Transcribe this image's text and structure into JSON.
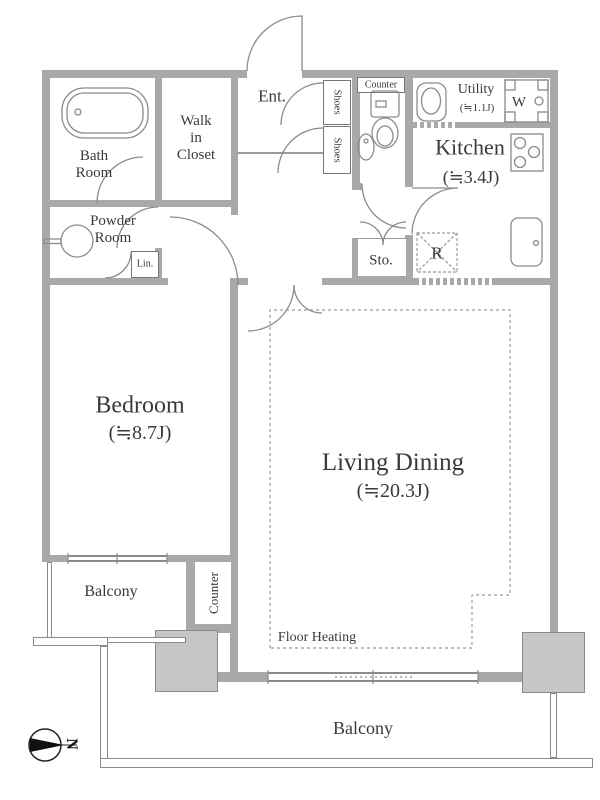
{
  "colors": {
    "wall": "#a9a9a9",
    "pillar": "#c6c6c6",
    "line": "#8b8b8b",
    "dashed_outline": "#999999",
    "text": "#3a3a3a",
    "compass": "#111111"
  },
  "labels": {
    "entrance": "Ent.",
    "bath_room": "Bath\nRoom",
    "walk_in_closet": "Walk\nin\nCloset",
    "powder_room": "Powder\nRoom",
    "linen": "Lin.",
    "shoes_upper": "Shoes",
    "shoes_lower": "Shoes",
    "wc_counter": "Counter",
    "utility": "Utility",
    "utility_size": "(≒1.1J)",
    "washer": "W",
    "kitchen": "Kitchen",
    "kitchen_size": "(≒3.4J)",
    "storage": "Sto.",
    "refrigerator": "R",
    "bedroom": "Bedroom",
    "bedroom_size": "(≒8.7J)",
    "living_dining": "Living Dining",
    "living_dining_size": "(≒20.3J)",
    "floor_heating": "Floor Heating",
    "balcony_left": "Balcony",
    "balcony_bottom": "Balcony",
    "balcony_counter": "Counter",
    "compass_north": "N"
  }
}
